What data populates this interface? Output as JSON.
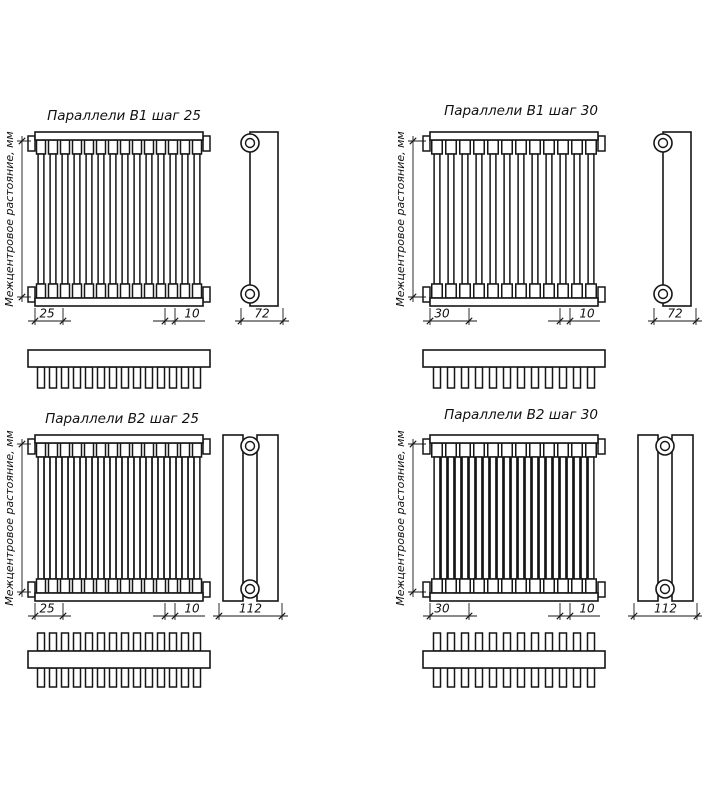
{
  "page": {
    "background": "#ffffff",
    "line_color": "#161616",
    "text_color": "#111111"
  },
  "drawings": [
    {
      "title": "Параллели В1 шаг 25",
      "axis_label": "Межцентровое растояние, мм",
      "pitch_label": "25",
      "tube_width_label": "10",
      "depth_label": "72",
      "tube_count": 14,
      "rows": 1
    },
    {
      "title": "Параллели В1 шаг 30",
      "axis_label": "Межцентровое растояние, мм",
      "pitch_label": "30",
      "tube_width_label": "10",
      "depth_label": "72",
      "tube_count": 12,
      "rows": 1
    },
    {
      "title": "Параллели В2 шаг 25",
      "axis_label": "Межцентровое растояние, мм",
      "pitch_label": "25",
      "tube_width_label": "10",
      "depth_label": "112",
      "tube_count": 14,
      "rows": 2
    },
    {
      "title": "Параллели В2 шаг 30",
      "axis_label": "Межцентровое растояние, мм",
      "pitch_label": "30",
      "tube_width_label": "10",
      "depth_label": "112",
      "tube_count": 12,
      "rows": 2
    }
  ]
}
